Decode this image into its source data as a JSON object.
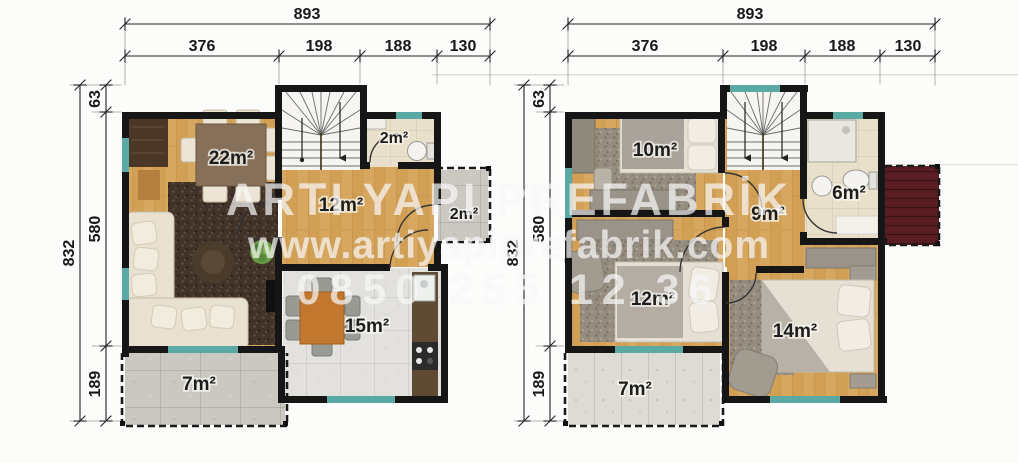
{
  "watermark": {
    "company": "ARTI YAPI PREFABRİK",
    "website": "www.artiyapiprefabrik.com",
    "phone": "0850 255 12 36"
  },
  "ground_floor": {
    "dims": {
      "w_total": "893",
      "w_segs": [
        "376",
        "198",
        "188",
        "130"
      ],
      "h_total": "832",
      "h_segs": [
        "63",
        "580",
        "189"
      ]
    },
    "rooms": {
      "living": "22m²",
      "hall": "12m²",
      "wc": "2m²",
      "porch": "2m²",
      "kitchen": "15m²",
      "terrace": "7m²"
    }
  },
  "upper_floor": {
    "dims": {
      "w_total": "893",
      "w_segs": [
        "376",
        "198",
        "188",
        "130"
      ],
      "h_total": "832",
      "h_segs": [
        "63",
        "580",
        "189"
      ]
    },
    "rooms": {
      "bedroom1": "10m²",
      "hall": "9m²",
      "bathroom": "6m²",
      "bedroom2": "12m²",
      "bedroom3": "14m²",
      "balcony": "7m²"
    }
  },
  "colors": {
    "wall": "#161616",
    "wood": "#d7a75f",
    "window_teal": "#5aa9a2",
    "deck_red": "#571d22",
    "tile_gray": "#e2e1dd",
    "tile_beige": "#e9e0cb",
    "terrace_gray": "#cbc8c2"
  }
}
